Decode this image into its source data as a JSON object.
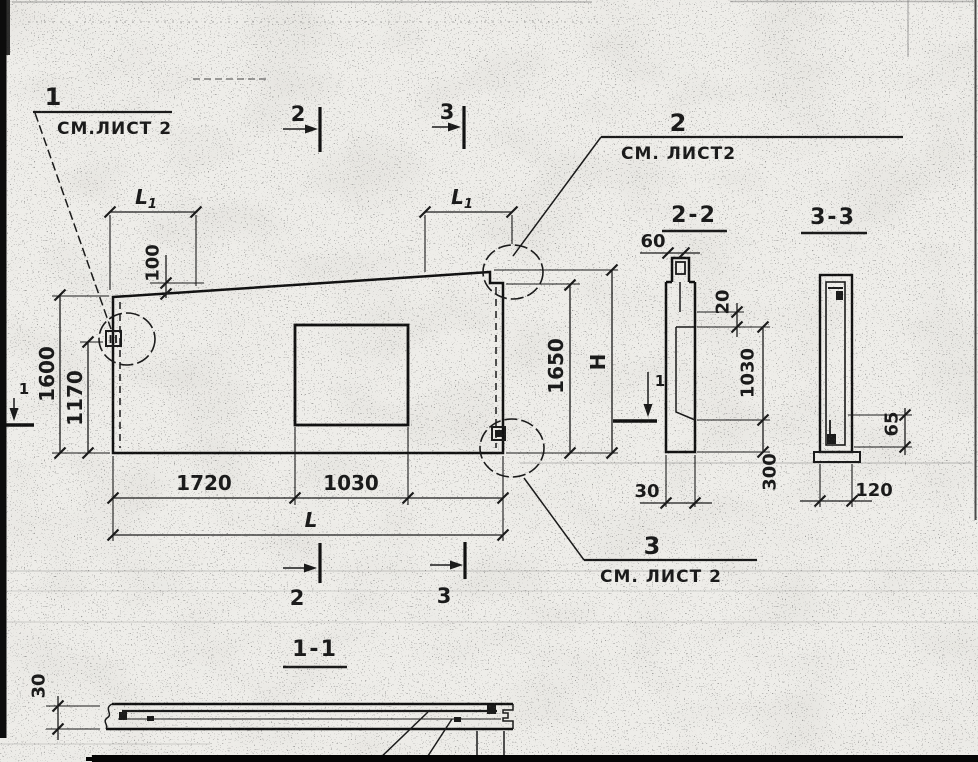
{
  "colors": {
    "paper": "#eeede9",
    "ink": "#1a1a1a"
  },
  "callouts": {
    "top_left": {
      "num": "1",
      "note": "СМ.ЛИСТ 2"
    },
    "top_right": {
      "num": "2",
      "note": "СМ. ЛИСТ2"
    },
    "bottom_right": {
      "num": "3",
      "note": "СМ. ЛИСТ 2"
    }
  },
  "markers": {
    "top_2": "2",
    "top_3": "3",
    "bottom_2": "2",
    "bottom_3": "3",
    "left_1": "1",
    "right_1": "1"
  },
  "plan": {
    "L1_main": "L",
    "L1_sub": "1",
    "rise": "100",
    "height_left": "1600",
    "height_mid": "1170",
    "height_right": "1650",
    "height_total": "Н",
    "width_left": "1720",
    "opening_width": "1030",
    "length_total": "L"
  },
  "sections": {
    "s22": {
      "title": "2-2",
      "top_width": "60",
      "step": "20",
      "recess": "1030",
      "bottom": "300",
      "thickness": "30"
    },
    "s33": {
      "title": "3-3",
      "edge": "65",
      "width": "120"
    },
    "s11": {
      "title": "1-1",
      "thickness": "30",
      "partial": "150"
    }
  }
}
